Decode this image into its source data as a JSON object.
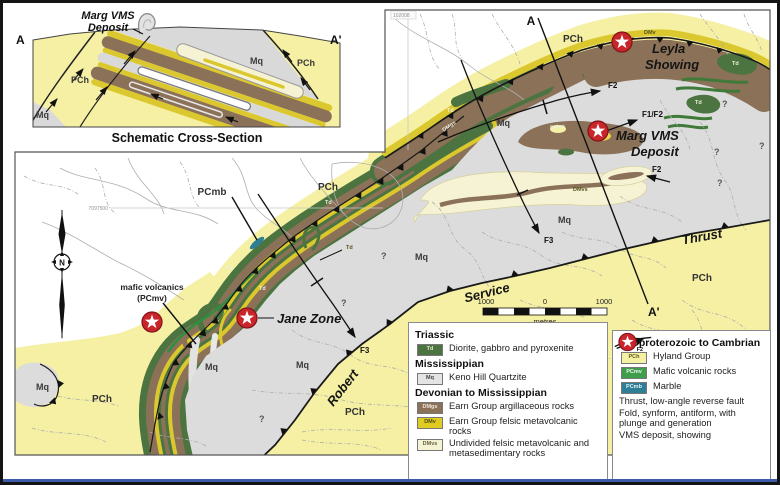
{
  "cross_section": {
    "deposit_line1": "Marg VMS",
    "deposit_line2": "Deposit",
    "end_left": "A",
    "end_right": "A'",
    "unit_pch": "PCh",
    "unit_mq": "Mq",
    "caption": "Schematic Cross-Section"
  },
  "map": {
    "section_start": "A",
    "section_end": "A'",
    "corner_ref": "102008",
    "grid_northing": "7097500",
    "units": {
      "pch": "PCh",
      "mq": "Mq",
      "td": "Td",
      "dmv": "DMv",
      "dmgs": "DMgs",
      "dmvs": "DMvs",
      "pcmb": "PCmb"
    },
    "annotations": {
      "leyla_line1": "Leyla",
      "leyla_line2": "Showing",
      "marg_line1": "Marg VMS",
      "marg_line2": "Deposit",
      "jane": "Jane Zone",
      "fault_word1": "Robert",
      "fault_word2": "Service",
      "fault_word3": "Thrust",
      "mafic_line1": "mafic volcanics",
      "mafic_line2": "(PCmv)",
      "f2": "F2",
      "f1f2": "F1/F2",
      "f3": "F3",
      "query": "?"
    },
    "compass_n": "N",
    "scale": {
      "left": "1000",
      "zero": "0",
      "right": "1000",
      "unit": "metres"
    }
  },
  "legend": {
    "left": [
      {
        "title": "Triassic",
        "items": [
          {
            "code": "Td",
            "color": "#4b7441",
            "text": "#e9e9c8",
            "label": "Diorite, gabbro and pyroxenite"
          }
        ]
      },
      {
        "title": "Mississippian",
        "items": [
          {
            "code": "Mq",
            "color": "#e4e4e4",
            "text": "#444444",
            "label": "Keno Hill Quartzite"
          }
        ]
      },
      {
        "title": "Devonian to Mississippian",
        "items": [
          {
            "code": "DMgs",
            "color": "#8b7158",
            "text": "#f0e6d8",
            "label": "Earn Group argillaceous rocks"
          },
          {
            "code": "DMv",
            "color": "#e0cb22",
            "text": "#4a4a10",
            "label": "Earn Group felsic metavolcanic rocks"
          },
          {
            "code": "DMvs",
            "color": "#f6f3d4",
            "text": "#666644",
            "label": "Undivided felsic metavolcanic and metasedimentary rocks"
          }
        ]
      }
    ],
    "right": {
      "title": "Neoproterozoic to Cambrian",
      "items": [
        {
          "code": "PCh",
          "color": "#f5f0a3",
          "text": "#5a5a20",
          "label": "Hyland Group"
        },
        {
          "code": "PCmv",
          "color": "#3f9e4c",
          "text": "#eaf5ea",
          "label": "Mafic volcanic rocks"
        },
        {
          "code": "PCmb",
          "color": "#2e7f96",
          "text": "#e6f2f5",
          "label": "Marble"
        }
      ],
      "symbols": [
        {
          "name": "thrust-fault",
          "label": "Thrust, low-angle reverse fault"
        },
        {
          "name": "fold-axis",
          "tag": "F2",
          "label": "Fold, synform, antiform, with plunge and generation"
        },
        {
          "name": "vms-star",
          "label": "VMS deposit, showing"
        }
      ]
    }
  },
  "colors": {
    "pch": "#f5f0a3",
    "mq": "#dcdcdc",
    "td": "#4b7441",
    "dmv": "#dbc72e",
    "dmgs": "#8b7158",
    "dmvs": "#f6f3d4",
    "pcmv": "#3f9e4c",
    "pcmb": "#2e7f96",
    "star_red": "#c9252b",
    "fault": "#1a1a1a",
    "stream": "#aeaeae"
  }
}
